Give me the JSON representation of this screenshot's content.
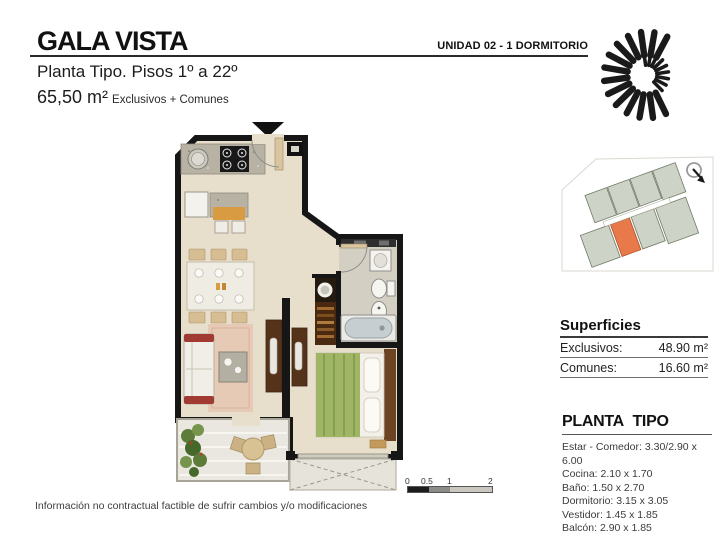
{
  "header": {
    "title": "GALA VISTA",
    "unit_label": "UNIDAD 02 - 1 DORMITORIO",
    "subtitle": "Planta Tipo. Pisos 1º a 22º",
    "area_value": "65,50 m²",
    "area_note": "Exclusivos +  Comunes"
  },
  "superficies": {
    "heading": "Superficies",
    "rows": [
      {
        "label": "Exclusivos:",
        "value": "48.90 m²"
      },
      {
        "label": "Comunes:",
        "value": "16.60 m²"
      }
    ]
  },
  "planta_tipo": {
    "heading": "PLANTA TIPO",
    "rooms": [
      "Estar - Comedor: 3.30/2.90 x 6.00",
      "Cocina: 2.10 x 1.70",
      "Baño: 1.50 x 2.70",
      "Dormitorio: 3.15 x 3.05",
      "Vestidor: 1.45 x 1.85",
      "Balcón: 2.90 x 1.85"
    ]
  },
  "scale_bar": {
    "labels": [
      "0",
      "0.5",
      "1",
      "2"
    ]
  },
  "footer": {
    "disclaimer": "Información no contractual factible de sufrir cambios y/o modificaciones"
  },
  "icons": {
    "logo": "spiral-sun-logo",
    "compass": "north-arrow",
    "entry_marker": "entry-arrow"
  },
  "colors": {
    "wall": "#161616",
    "floor": "#e7decb",
    "highlight_unit": "#e8794b",
    "keyplan_unit": "#cdd3c6"
  }
}
